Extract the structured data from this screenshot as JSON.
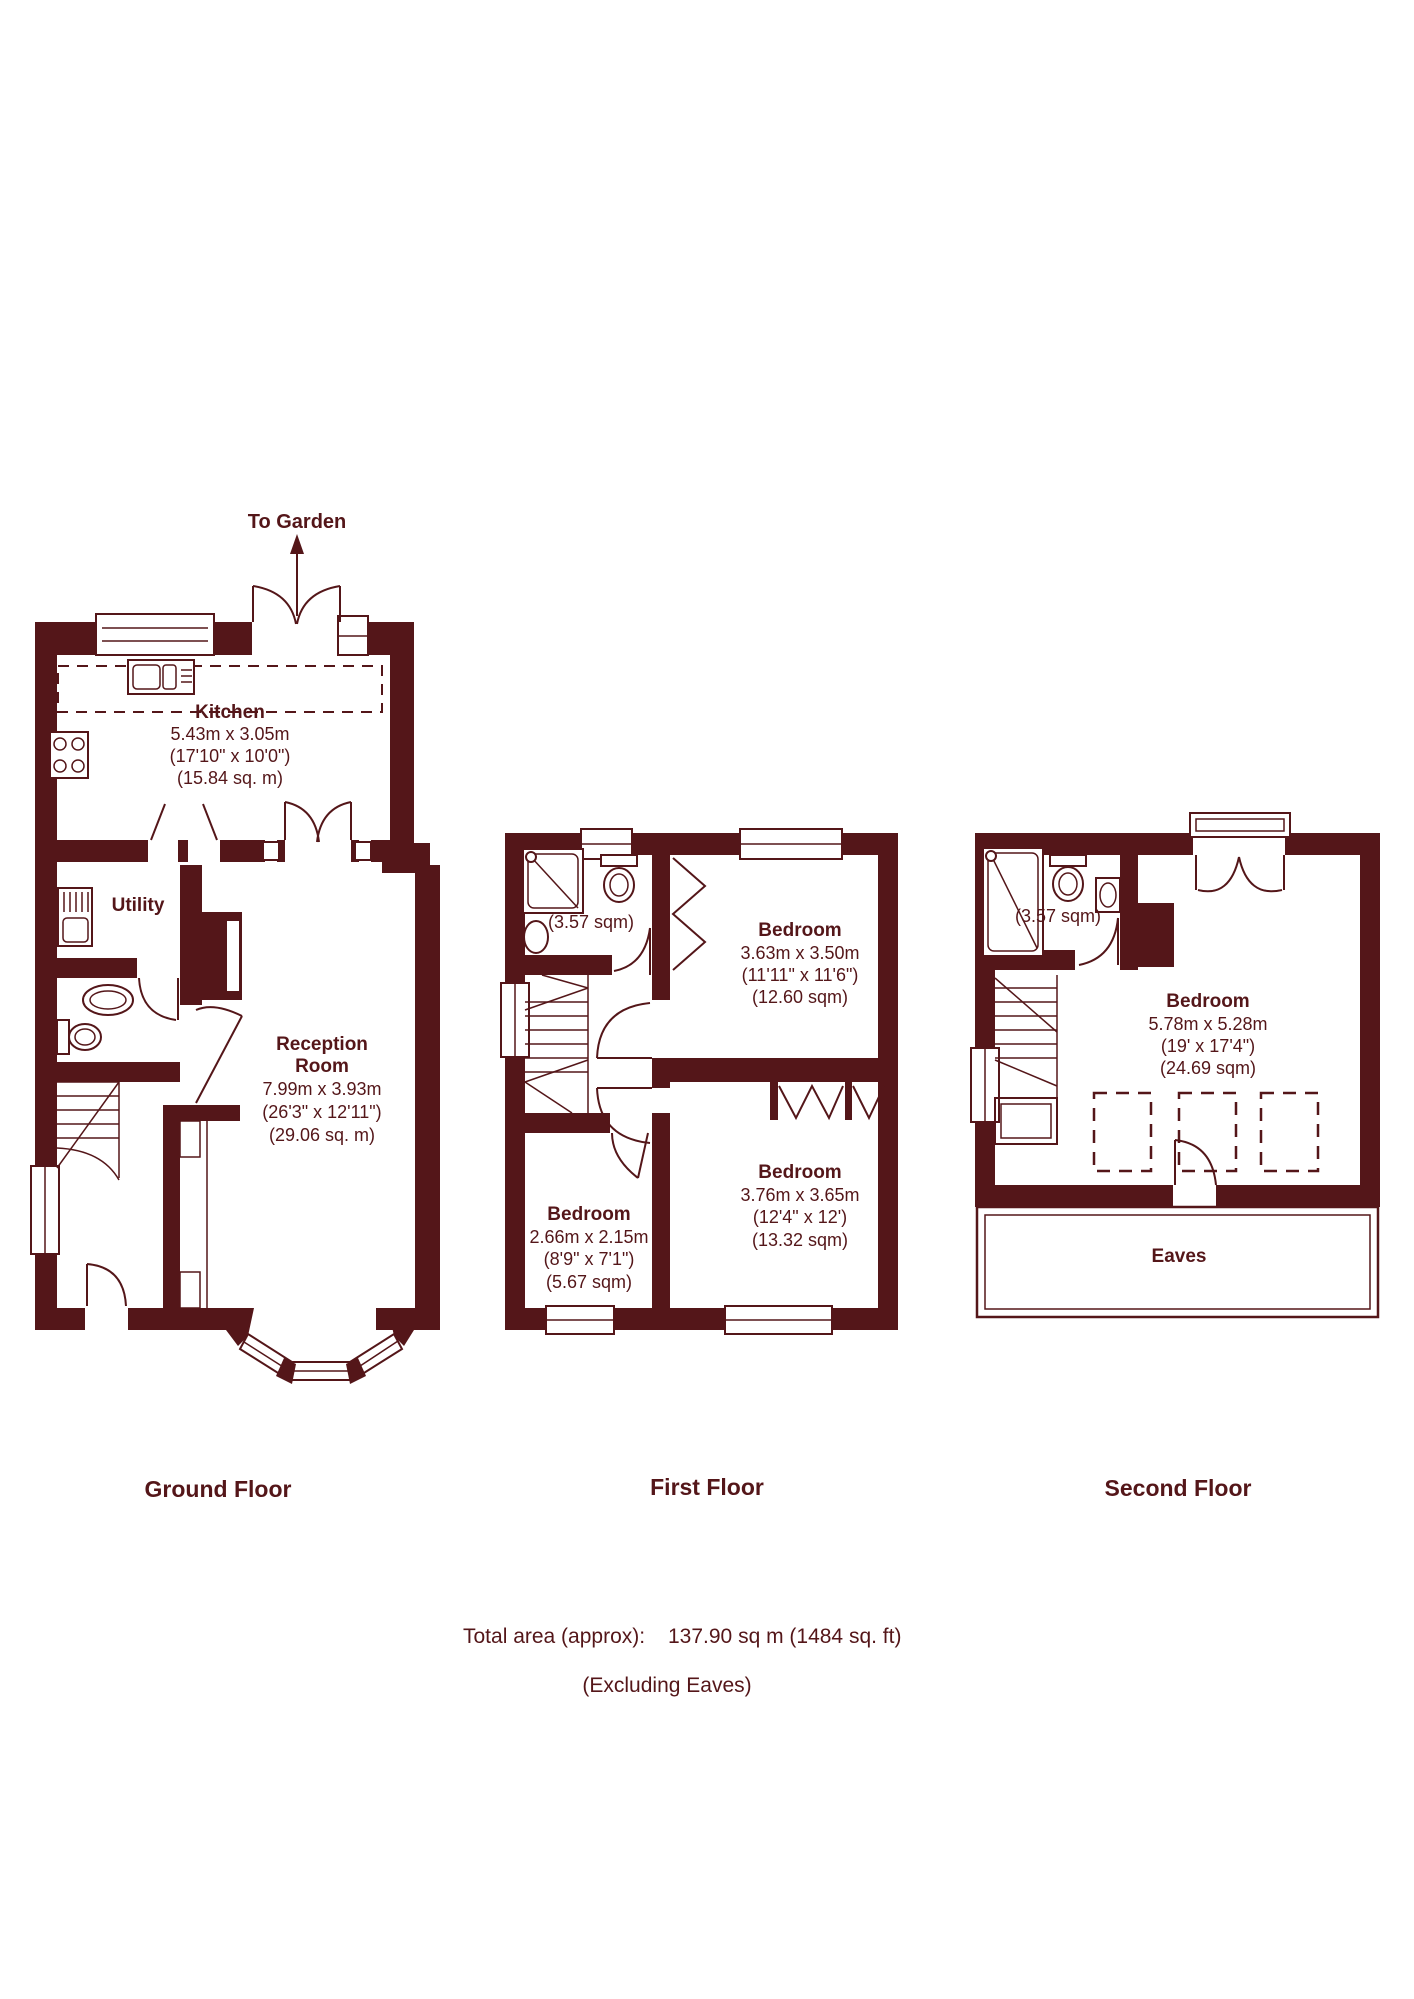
{
  "colors": {
    "wall": "#541619",
    "background": "#ffffff"
  },
  "ground_floor": {
    "label": "Ground Floor",
    "garden_label": "To Garden",
    "kitchen": {
      "name": "Kitchen",
      "metric": "5.43m x 3.05m",
      "imperial": "(17'10\" x 10'0\")",
      "area": "(15.84 sq. m)"
    },
    "utility": {
      "name": "Utility"
    },
    "reception": {
      "name_line1": "Reception",
      "name_line2": "Room",
      "metric": "7.99m x 3.93m",
      "imperial": "(26'3\" x 12'11\")",
      "area": "(29.06 sq. m)"
    }
  },
  "first_floor": {
    "label": "First Floor",
    "bathroom": {
      "area": "(3.57 sqm)"
    },
    "bedroom_front": {
      "name": "Bedroom",
      "metric": "3.63m x 3.50m",
      "imperial": "(11'11\" x 11'6\")",
      "area": "(12.60 sqm)"
    },
    "bedroom_rear": {
      "name": "Bedroom",
      "metric": "3.76m x 3.65m",
      "imperial": "(12'4\" x 12')",
      "area": "(13.32 sqm)"
    },
    "bedroom_small": {
      "name": "Bedroom",
      "metric": "2.66m x 2.15m",
      "imperial": "(8'9\" x 7'1\")",
      "area": "(5.67 sqm)"
    }
  },
  "second_floor": {
    "label": "Second Floor",
    "shower_room": {
      "area": "(3.57 sqm)"
    },
    "bedroom": {
      "name": "Bedroom",
      "metric": "5.78m x 5.28m",
      "imperial": "(19' x 17'4\")",
      "area": "(24.69 sqm)"
    },
    "eaves_label": "Eaves"
  },
  "summary": {
    "total_label": "Total area (approx):",
    "total_value": "137.90 sq m (1484 sq. ft)",
    "note": "(Excluding Eaves)"
  }
}
